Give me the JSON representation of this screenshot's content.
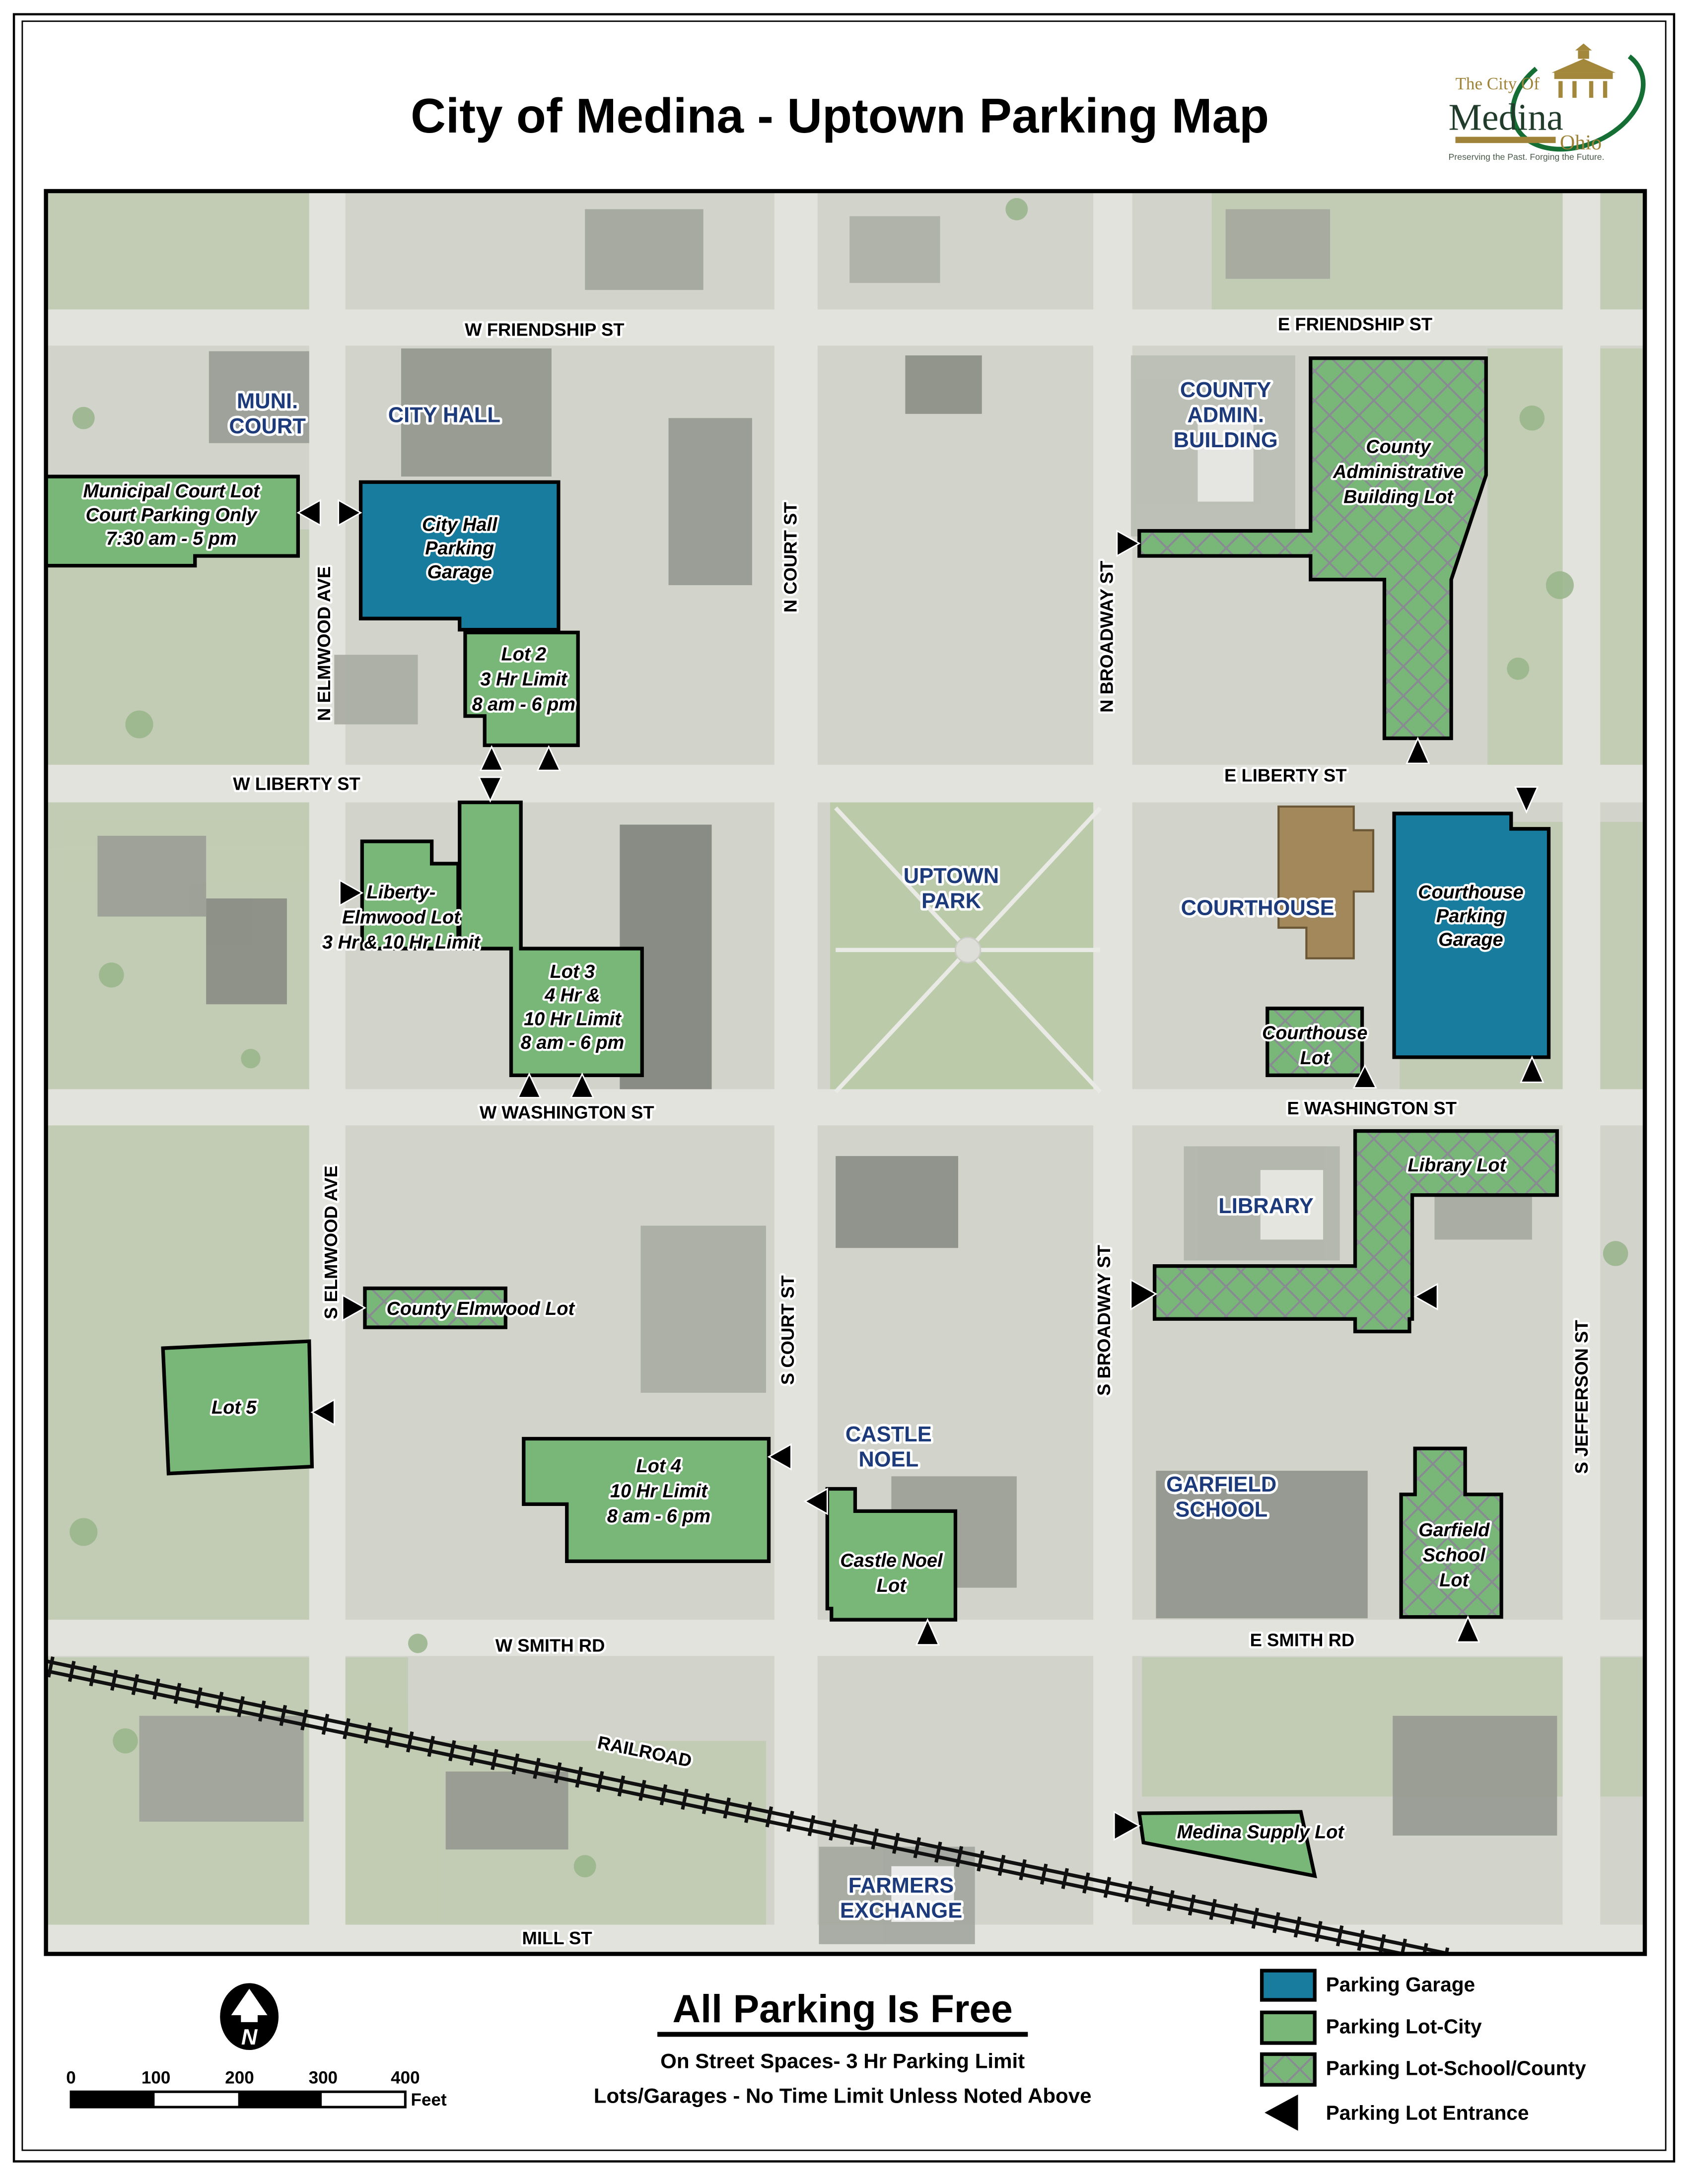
{
  "header": {
    "title": "City of Medina - Uptown Parking Map",
    "logo": {
      "city_of": "The City Of",
      "name": "Medina",
      "state": "Ohio",
      "tagline": "Preserving the Past. Forging the Future."
    }
  },
  "map": {
    "streets": {
      "w_friendship": "W FRIENDSHIP ST",
      "e_friendship": "E FRIENDSHIP ST",
      "w_liberty": "W LIBERTY ST",
      "e_liberty": "E LIBERTY ST",
      "w_washington": "W WASHINGTON ST",
      "e_washington": "E WASHINGTON ST",
      "w_smith": "W SMITH RD",
      "e_smith": "E SMITH RD",
      "mill": "MILL ST",
      "railroad": "RAILROAD",
      "n_elmwood": "N ELMWOOD AVE",
      "s_elmwood": "S ELMWOOD AVE",
      "n_court": "N COURT ST",
      "s_court": "S COURT ST",
      "n_broadway": "N BROADWAY ST",
      "s_broadway": "S BROADWAY ST",
      "s_jefferson": "S JEFFERSON ST"
    },
    "places": {
      "muni_court": [
        "MUNI.",
        "COURT"
      ],
      "city_hall": "CITY HALL",
      "county_admin": [
        "COUNTY",
        "ADMIN.",
        "BUILDING"
      ],
      "uptown_park": [
        "UPTOWN",
        "PARK"
      ],
      "courthouse": "COURTHOUSE",
      "library": "LIBRARY",
      "castle_noel": [
        "CASTLE",
        "NOEL"
      ],
      "garfield_school": [
        "GARFIELD",
        "SCHOOL"
      ],
      "farmers_exchange": [
        "FARMERS",
        "EXCHANGE"
      ]
    },
    "lots": {
      "municipal": {
        "type": "city",
        "lines": [
          "Municipal Court Lot",
          "Court Parking Only",
          "7:30 am - 5 pm"
        ]
      },
      "city_hall_garage": {
        "type": "garage",
        "lines": [
          "City Hall",
          "Parking",
          "Garage"
        ]
      },
      "lot2": {
        "type": "city",
        "lines": [
          "Lot 2",
          "3 Hr Limit",
          "8 am - 6 pm"
        ]
      },
      "liberty_elmwood": {
        "type": "city",
        "lines": [
          "Liberty-",
          "Elmwood Lot",
          "3 Hr & 10 Hr Limit"
        ]
      },
      "lot3": {
        "type": "city",
        "lines": [
          "Lot 3",
          "4 Hr &",
          "10 Hr Limit",
          "8 am - 6 pm"
        ]
      },
      "county_admin_lot": {
        "type": "school_county",
        "lines": [
          "County",
          "Administrative",
          "Building Lot"
        ]
      },
      "courthouse_garage": {
        "type": "garage",
        "lines": [
          "Courthouse",
          "Parking",
          "Garage"
        ]
      },
      "courthouse_lot": {
        "type": "school_county",
        "lines": [
          "Courthouse",
          "Lot"
        ]
      },
      "library_lot": {
        "type": "school_county",
        "lines": [
          "Library Lot"
        ]
      },
      "county_elmwood": {
        "type": "school_county",
        "lines": [
          "County Elmwood Lot"
        ]
      },
      "lot5": {
        "type": "city",
        "lines": [
          "Lot 5"
        ]
      },
      "lot4": {
        "type": "city",
        "lines": [
          "Lot 4",
          "10 Hr Limit",
          "8 am - 6 pm"
        ]
      },
      "castle_noel_lot": {
        "type": "city",
        "lines": [
          "Castle Noel",
          "Lot"
        ]
      },
      "garfield_lot": {
        "type": "school_county",
        "lines": [
          "Garfield",
          "School",
          "Lot"
        ]
      },
      "medina_supply": {
        "type": "city",
        "lines": [
          "Medina Supply Lot"
        ]
      }
    }
  },
  "footer": {
    "heading": "All Parking Is Free",
    "note1": "On Street Spaces- 3 Hr Parking Limit",
    "note2": "Lots/Garages - No Time Limit Unless Noted Above",
    "north_letter": "N",
    "scale": {
      "ticks": [
        "0",
        "100",
        "200",
        "300",
        "400"
      ],
      "unit": "Feet"
    }
  },
  "legend": {
    "items": [
      {
        "label": "Parking Garage",
        "swatch": "garage"
      },
      {
        "label": "Parking Lot-City",
        "swatch": "lot-city"
      },
      {
        "label": "Parking Lot-School/County",
        "swatch": "lot-school-county"
      },
      {
        "label": "Parking Lot Entrance",
        "swatch": "entrance-arrow"
      }
    ]
  },
  "colors": {
    "garage": "#187c9f",
    "lot_city": "#79b778",
    "hatch_line": "#888b92",
    "place_navy": "#1d3a7a",
    "courthouse_brown": "#a3885c"
  }
}
